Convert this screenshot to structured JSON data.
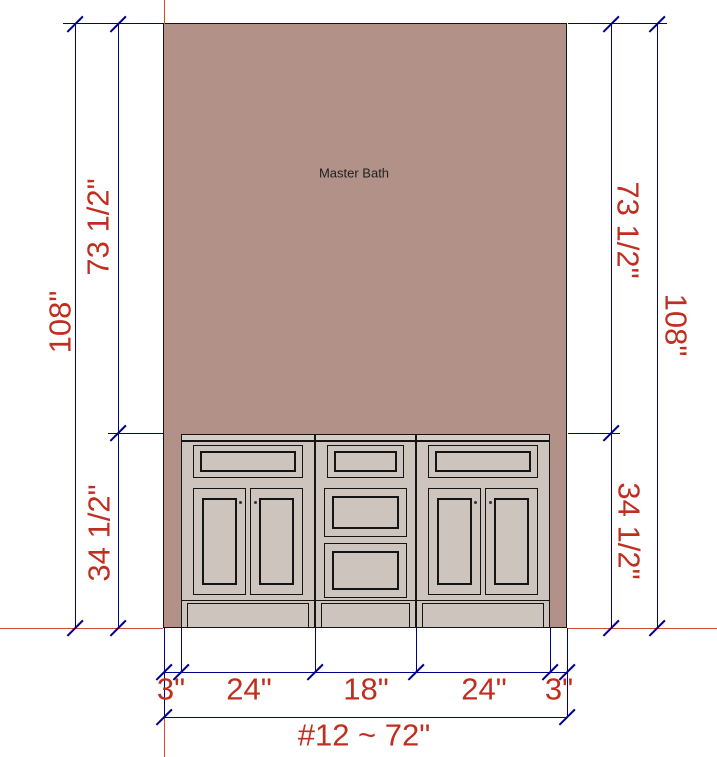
{
  "drawing": {
    "room_label": "Master Bath",
    "item_label": "#12 ~ 72\"",
    "left_dims": {
      "overall": "108\"",
      "upper": "73 1/2\"",
      "lower": "34 1/2\""
    },
    "right_dims": {
      "upper": "73 1/2\"",
      "overall": "108\"",
      "lower": "34 1/2\""
    },
    "bottom_dims": [
      "3\"",
      "24\"",
      "18\"",
      "24\"",
      "3\""
    ],
    "cabinets": [
      {
        "name": "left sink base",
        "width": "24\"",
        "fronts": "1 drawer + 2 doors"
      },
      {
        "name": "center drawer bank",
        "width": "18\"",
        "fronts": "3 drawers"
      },
      {
        "name": "right sink base",
        "width": "24\"",
        "fronts": "1 drawer + 2 doors"
      }
    ],
    "wall_height": "108\"",
    "cabinet_height": "34 1/2\""
  },
  "colors": {
    "bg": "#ffffff",
    "wall": "#b29189",
    "cabinet": "#cdc5bd",
    "countertop": "#d6cfc8",
    "outline": "#141414",
    "dimline": "#00008b",
    "dimtext": "#c02e20",
    "refline": "#cf4b31",
    "roomtext": "#1f1f1f"
  }
}
